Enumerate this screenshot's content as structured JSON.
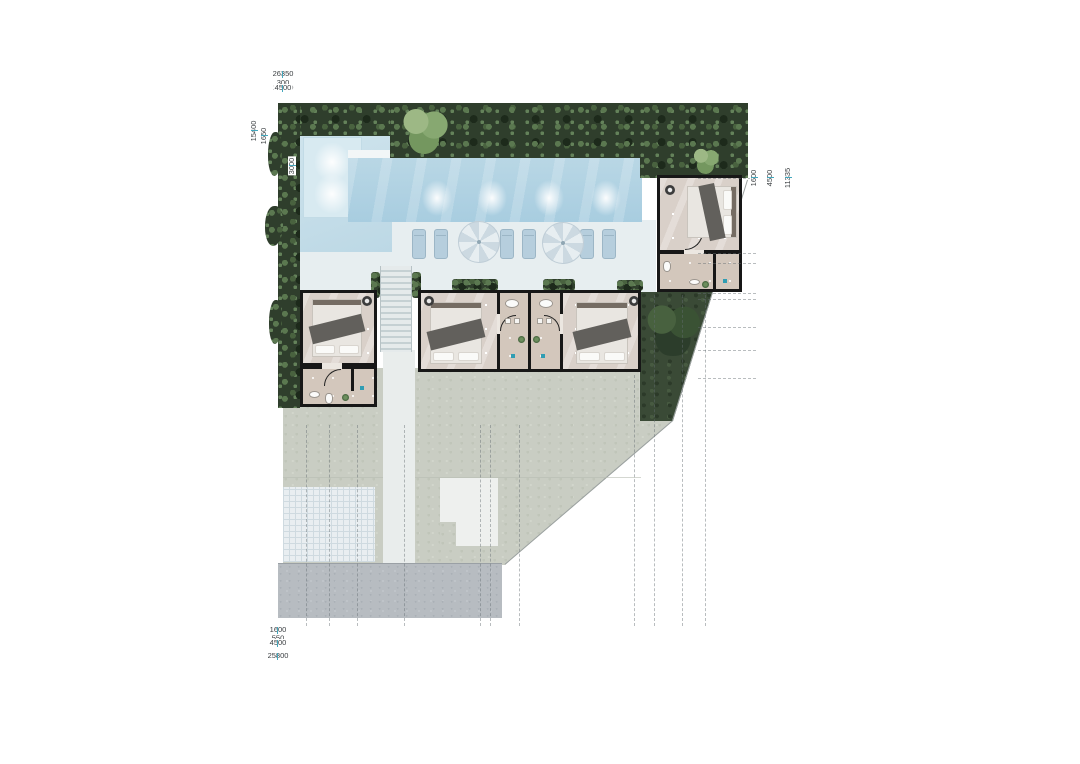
{
  "dims": {
    "top": {
      "overall": "26350",
      "segments": [
        "300",
        "5850",
        "300",
        "14200",
        "300",
        "900",
        "4500"
      ]
    },
    "bottom": {
      "overall": "25800",
      "segments": [
        "1600",
        "1300",
        "1600",
        "2650",
        "4300",
        "550",
        "1650",
        "6500",
        "1150",
        "1600",
        "1300",
        "1600"
      ],
      "group_left": "4500",
      "group_right": "4500"
    },
    "left": {
      "overall": "15400",
      "segments": [
        "5800",
        "1100",
        "1400",
        "4300",
        "550",
        "1650"
      ],
      "pool_inset": "3000"
    },
    "right": {
      "overall": "11335",
      "segments": [
        "4250",
        "550",
        "1700",
        "335",
        "1600",
        "1300",
        "1600"
      ],
      "group_upper": "6500",
      "group_lower": "4500"
    }
  },
  "palette": {
    "pool_water": "#aecfe0",
    "hedge_green": "#2f3e2c",
    "lawn_green": "#3a4a36",
    "terrace_gray": "#c9cdc3",
    "wall_black": "#171717",
    "dimension_tick": "#43a7bd"
  }
}
